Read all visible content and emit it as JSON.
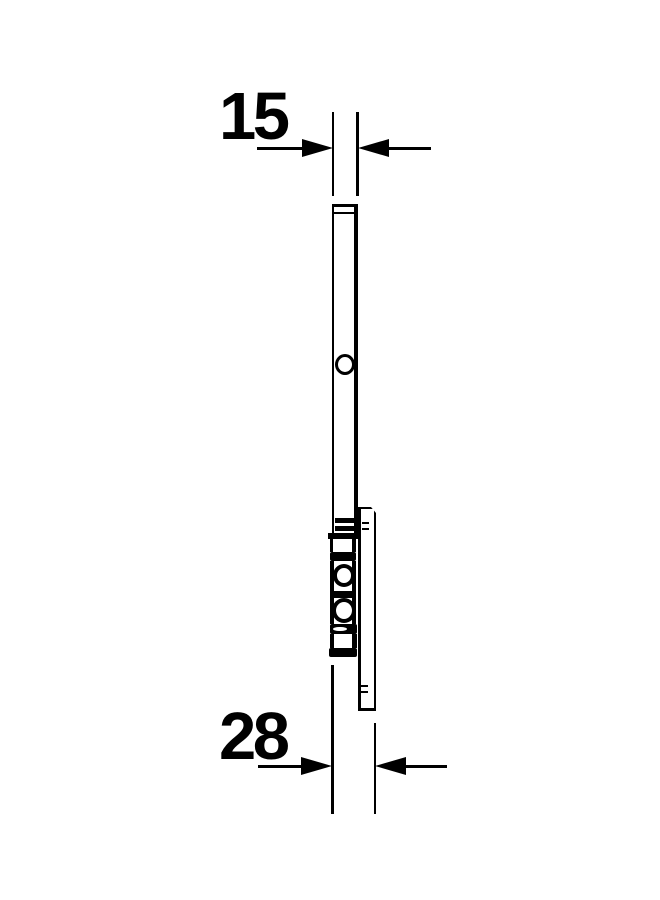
{
  "drawing": {
    "dimension_top": {
      "label": "15"
    },
    "dimension_bottom": {
      "label": "28"
    },
    "colors": {
      "line": "#000000",
      "background": "#ffffff"
    }
  }
}
